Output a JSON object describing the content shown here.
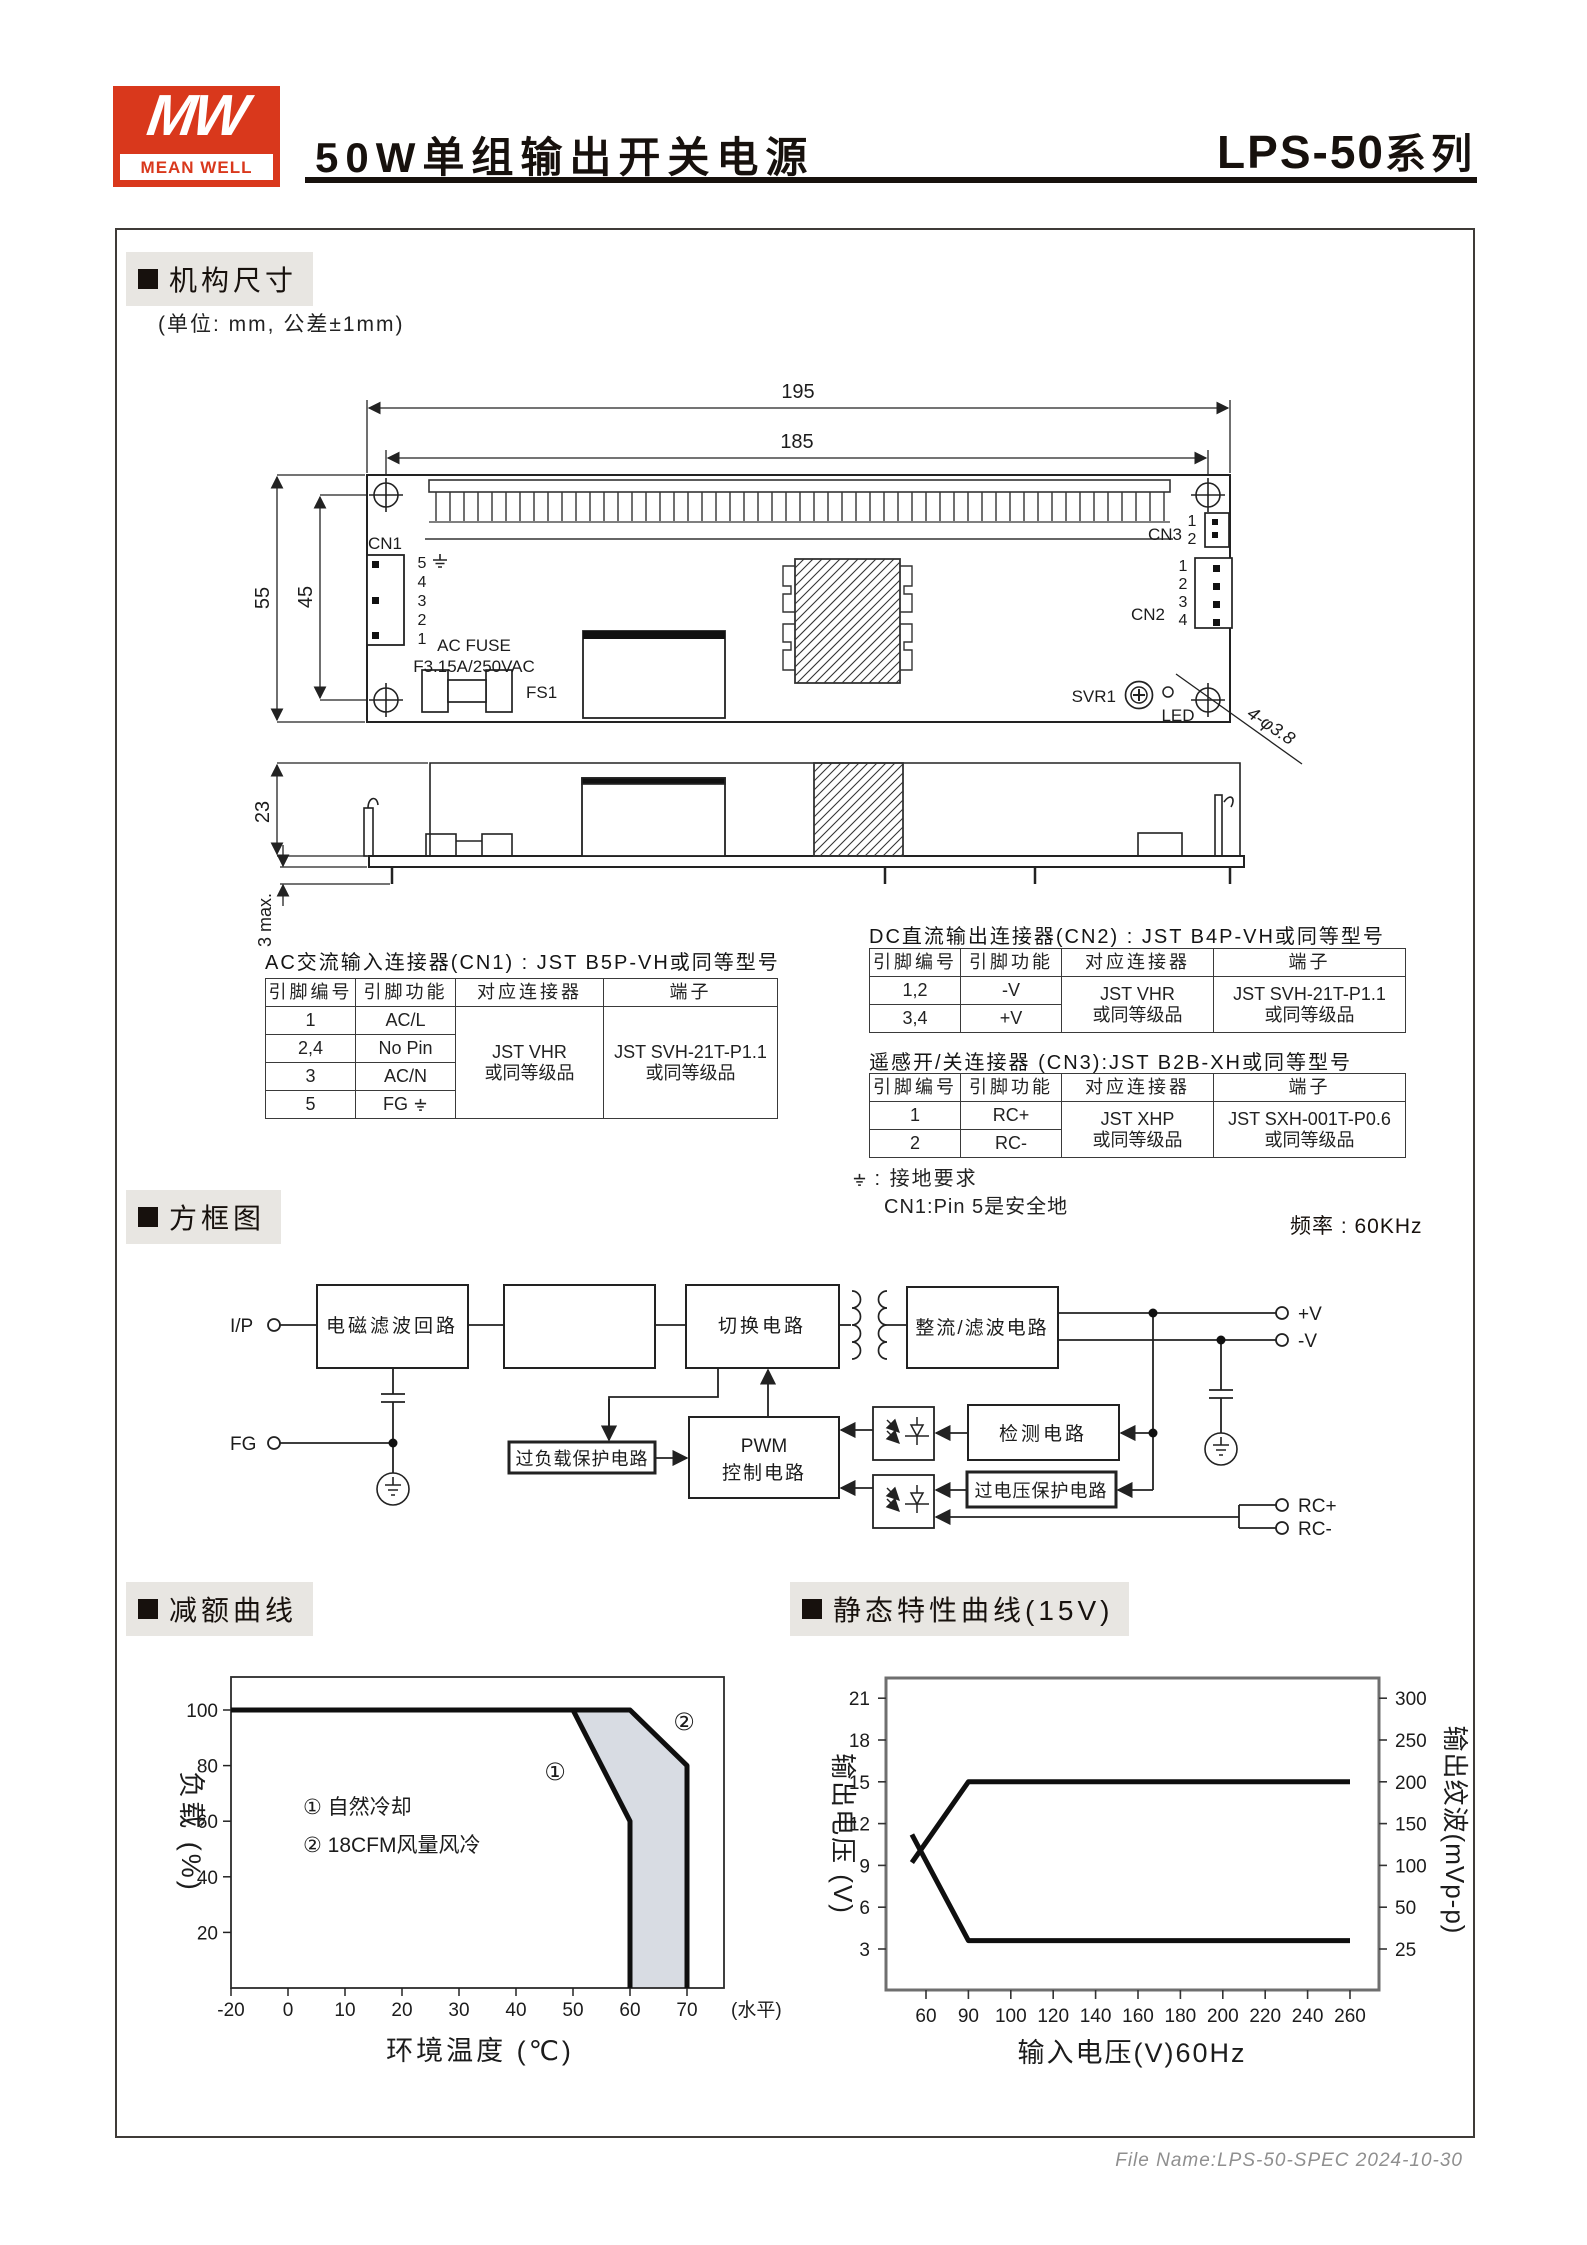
{
  "header": {
    "logo_mw": "MW",
    "logo_brand": "MEAN WELL",
    "title": "50W单组输出开关电源",
    "series_model": "LPS-50",
    "series_suffix": "系列"
  },
  "sections": {
    "mechanical": "机构尺寸",
    "block_diagram": "方框图",
    "derating": "减额曲线",
    "static_curve": "静态特性曲线(15V)"
  },
  "mech": {
    "unit_note": "(单位: mm, 公差±1mm)",
    "dims": {
      "w_outer": "195",
      "w_inner": "185",
      "h_outer": "55",
      "h_inner": "45",
      "side_h": "23",
      "pin_len": "3 max."
    },
    "labels": {
      "cn1": "CN1",
      "cn2": "CN2",
      "cn3": "CN3",
      "svr1": "SVR1",
      "led": "LED",
      "fs1": "FS1",
      "fuse1": "AC FUSE",
      "fuse2": "F3.15A/250VAC",
      "holes": "4-φ3.8"
    },
    "cn1_pins": [
      "5",
      "4",
      "3",
      "2",
      "1"
    ],
    "cn2_pins": [
      "1",
      "2",
      "3",
      "4"
    ],
    "cn3_pins": [
      "1",
      "2"
    ]
  },
  "tables": {
    "col_headers": [
      "引脚编号",
      "引脚功能",
      "对应连接器",
      "端子"
    ],
    "cn1": {
      "title": "AC交流输入连接器(CN1) : JST B5P-VH或同等型号",
      "rows": [
        [
          "1",
          "AC/L"
        ],
        [
          "2,4",
          "No Pin"
        ],
        [
          "3",
          "AC/N"
        ],
        [
          "5",
          "FG ⏚"
        ]
      ],
      "connector": [
        "JST VHR",
        "或同等级品"
      ],
      "terminal": [
        "JST SVH-21T-P1.1",
        "或同等级品"
      ]
    },
    "cn2": {
      "title": "DC直流输出连接器(CN2) : JST B4P-VH或同等型号",
      "rows": [
        [
          "1,2",
          "-V"
        ],
        [
          "3,4",
          "+V"
        ]
      ],
      "connector": [
        "JST VHR",
        "或同等级品"
      ],
      "terminal": [
        "JST SVH-21T-P1.1",
        "或同等级品"
      ]
    },
    "cn3": {
      "title": "遥感开/关连接器 (CN3):JST B2B-XH或同等型号",
      "rows": [
        [
          "1",
          "RC+"
        ],
        [
          "2",
          "RC-"
        ]
      ],
      "connector": [
        "JST XHP",
        "或同等级品"
      ],
      "terminal": [
        "JST SXH-001T-P0.6",
        "或同等级品"
      ]
    },
    "ground_note_1": "⏚ : 接地要求",
    "ground_note_2": "CN1:Pin 5是安全地"
  },
  "block": {
    "freq_note": "频率 : 60KHz",
    "terminals": {
      "ip": "I/P",
      "fg": "FG",
      "vp": "+V",
      "vn": "-V",
      "rcp": "RC+",
      "rcn": "RC-"
    },
    "boxes": {
      "emi": "电磁滤波回路",
      "rectifier_in": "整流/滤波电路",
      "switch": "切换电路",
      "rectifier_out": "整流/滤波电路",
      "olp": "过负载保护电路",
      "pwm1": "PWM",
      "pwm2": "控制电路",
      "detect": "检测电路",
      "ovp": "过电压保护电路"
    }
  },
  "chart_data": [
    {
      "type": "area",
      "title": "减额曲线",
      "xlabel": "环境温度 (℃)",
      "ylabel": "负载 (%)",
      "x_ticks": [
        -20,
        0,
        10,
        20,
        30,
        40,
        50,
        60,
        70
      ],
      "x_suffix": "(水平)",
      "y_ticks": [
        20,
        40,
        60,
        80,
        100
      ],
      "ylim": [
        0,
        110
      ],
      "grid": false,
      "legend": [
        "① 自然冷却",
        "② 18CFM风量风冷"
      ],
      "series": [
        {
          "name": "自然冷却",
          "mark": "①",
          "points": [
            [
              -20,
              100
            ],
            [
              50,
              100
            ],
            [
              60,
              60
            ],
            [
              60,
              0
            ]
          ]
        },
        {
          "name": "18CFM风量风冷",
          "mark": "②",
          "points": [
            [
              -20,
              100
            ],
            [
              60,
              100
            ],
            [
              70,
              80
            ],
            [
              70,
              0
            ]
          ]
        }
      ],
      "shade_between": true,
      "shade_color": "#d8dce3"
    },
    {
      "type": "line",
      "title": "静态特性曲线(15V)",
      "xlabel": "输入电压(V)60Hz",
      "ylabel_left": "输出电压 (V)",
      "ylabel_right": "输出纹波(mVp-p)",
      "x_ticks": [
        60,
        90,
        100,
        120,
        140,
        160,
        180,
        200,
        220,
        240,
        260
      ],
      "y_ticks_left": [
        3,
        6,
        9,
        12,
        15,
        18,
        21
      ],
      "y_ticks_right": [
        25,
        50,
        100,
        150,
        200,
        250,
        300
      ],
      "grid": false,
      "series": [
        {
          "name": "输出电压",
          "axis": "left",
          "points": [
            [
              50,
              9.2
            ],
            [
              90,
              15
            ],
            [
              260,
              15
            ]
          ]
        },
        {
          "name": "输出纹波",
          "axis": "right",
          "points": [
            [
              50,
              137
            ],
            [
              90,
              30
            ],
            [
              260,
              30
            ]
          ]
        }
      ]
    }
  ],
  "footer": {
    "file_note": "File Name:LPS-50-SPEC  2024-10-30"
  }
}
